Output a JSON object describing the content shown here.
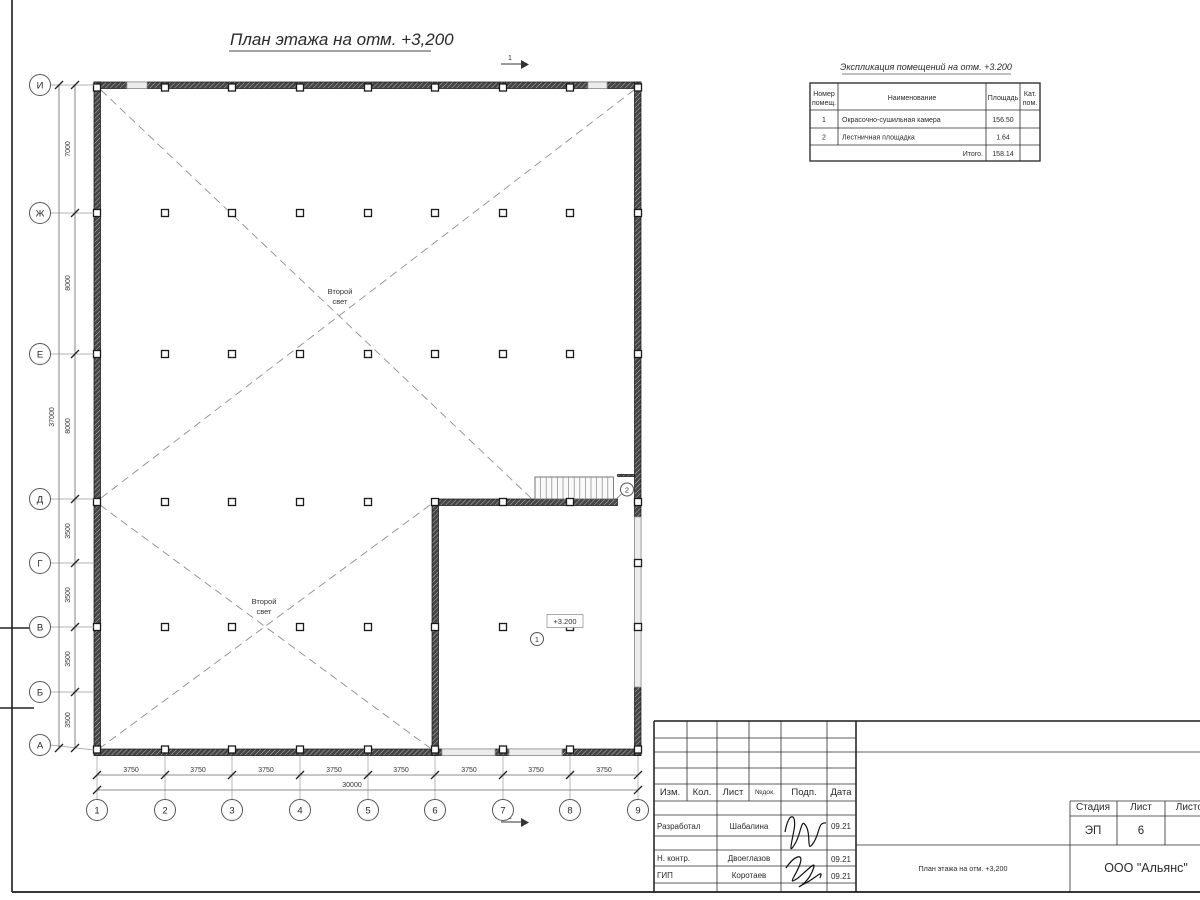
{
  "title": "План этажа на отм. +3,200",
  "section_label": "1",
  "colors": {
    "ink": "#2a2a2a",
    "wall_fill": "#454545",
    "light_opening": "#ececec"
  },
  "plan": {
    "second_light_line1": "Второй",
    "second_light_line2": "свет",
    "elevation_mark": "+3.200",
    "room1_tag": "1",
    "room2_tag": "2",
    "axes_rows": [
      "И",
      "Ж",
      "Е",
      "Д",
      "Г",
      "В",
      "Б",
      "А"
    ],
    "axes_cols": [
      "1",
      "2",
      "3",
      "4",
      "5",
      "6",
      "7",
      "8",
      "9"
    ],
    "dims_left": [
      "7000",
      "8000",
      "8000",
      "3500",
      "3500",
      "3500",
      "3500"
    ],
    "dim_left_total": "37000",
    "dims_bottom": [
      "3750",
      "3750",
      "3750",
      "3750",
      "3750",
      "3750",
      "3750",
      "3750"
    ],
    "dim_bottom_total": "30000"
  },
  "expl": {
    "title": "Экспликация помещений на отм. +3.200",
    "h_num1": "Номер",
    "h_num2": "помещ.",
    "h_name": "Наименование",
    "h_area": "Площадь",
    "h_cat1": "Кат.",
    "h_cat2": "пом.",
    "rows": [
      {
        "num": "1",
        "name": "Окрасочно-сушильная камера",
        "area": "156.50"
      },
      {
        "num": "2",
        "name": "Лестничная площадка",
        "area": "1.64"
      }
    ],
    "total_label": "Итого.",
    "total_value": "158.14"
  },
  "title_block": {
    "h_izm": "Изм.",
    "h_kol": "Кол.",
    "h_list": "Лист",
    "h_ndok": "№док.",
    "h_podp": "Подп.",
    "h_data": "Дата",
    "rows": [
      {
        "role": "Разработал",
        "name": "Шабалина",
        "date": "09.21"
      },
      {
        "role": "Н. контр.",
        "name": "Двоеглазов",
        "date": "09.21"
      },
      {
        "role": "ГИП",
        "name": "Коротаев",
        "date": "09.21"
      }
    ],
    "stage_label": "Стадия",
    "sheet_label": "Лист",
    "sheets_label": "Листов",
    "stage_value": "ЭП",
    "sheet_value": "6",
    "doc_name": "План этажа на отм. +3,200",
    "org_name": "ООО \"Альянс\""
  }
}
